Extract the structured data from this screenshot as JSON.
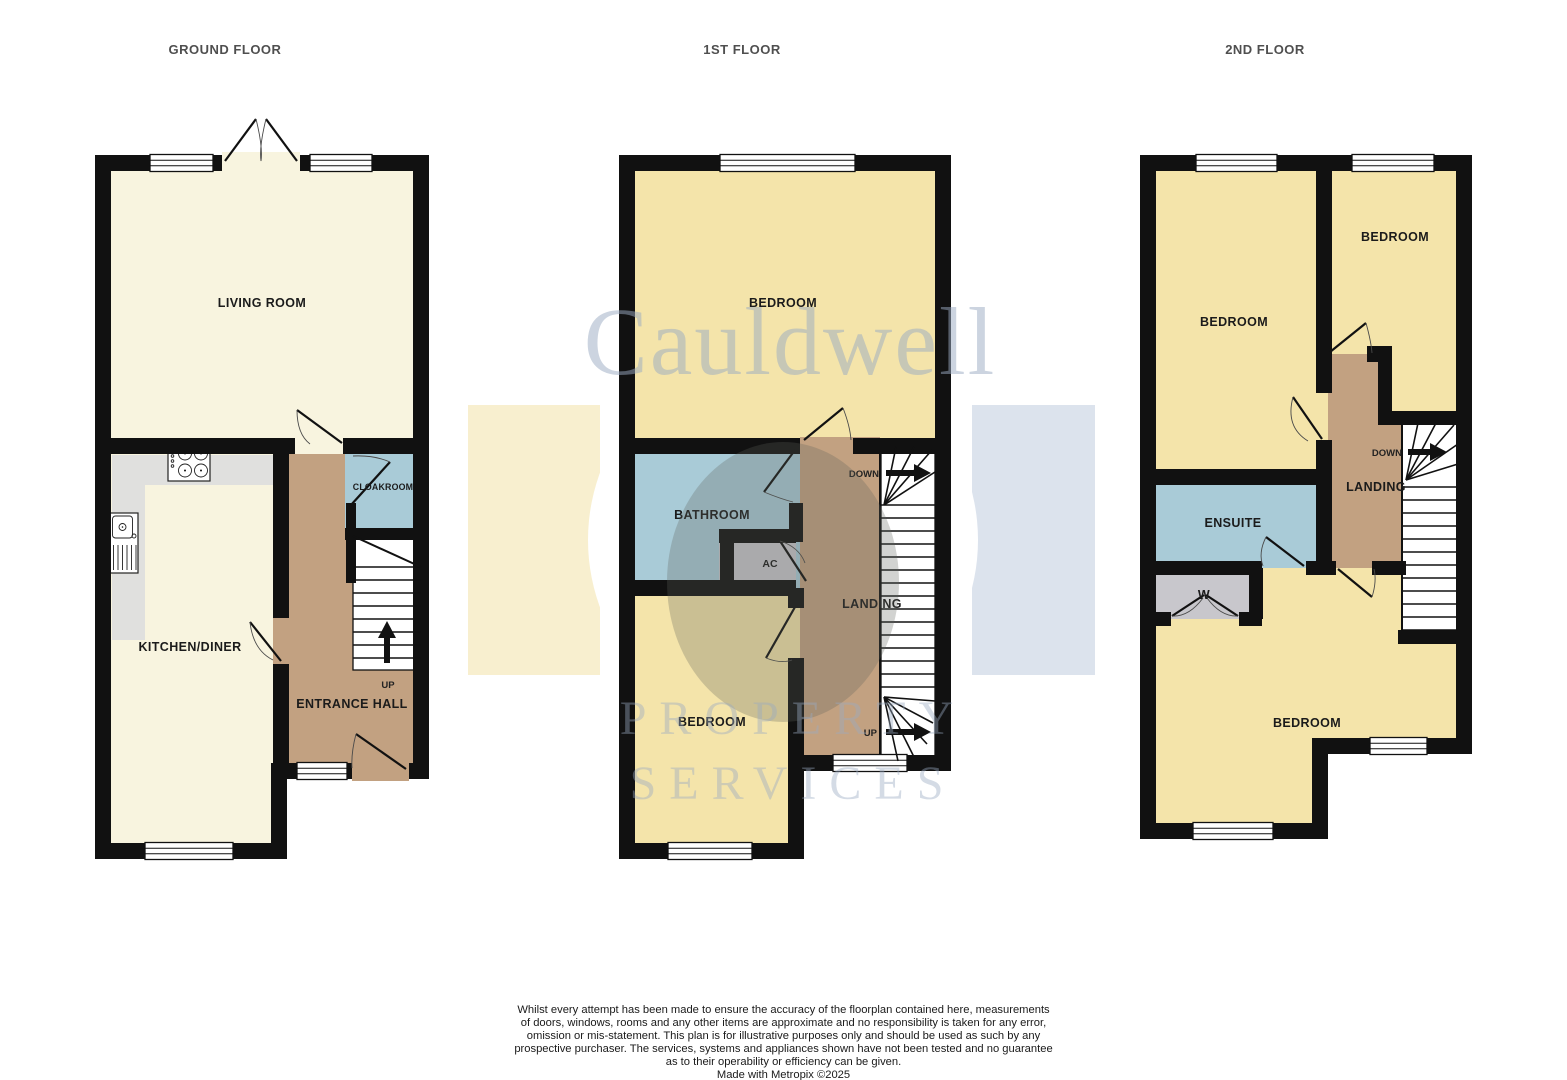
{
  "floors": [
    {
      "title": "GROUND FLOOR",
      "rooms": {
        "living_room": "LIVING ROOM",
        "kitchen_diner": "KITCHEN/DINER",
        "cloakroom": "CLOAKROOM",
        "entrance_hall": "ENTRANCE HALL"
      },
      "stairs": {
        "up_label": "UP"
      }
    },
    {
      "title": "1ST FLOOR",
      "rooms": {
        "bedroom_top": "BEDROOM",
        "bathroom": "BATHROOM",
        "airing_cupboard": "AC",
        "landing": "LANDING",
        "bedroom_bottom": "BEDROOM"
      },
      "stairs": {
        "down_label": "DOWN",
        "up_label": "UP"
      }
    },
    {
      "title": "2ND FLOOR",
      "rooms": {
        "bedroom_left": "BEDROOM",
        "bedroom_right": "BEDROOM",
        "ensuite": "ENSUITE",
        "wardrobe": "W",
        "landing": "LANDING",
        "bedroom_bottom": "BEDROOM"
      },
      "stairs": {
        "down_label": "DOWN"
      }
    }
  ],
  "watermark": {
    "brand": "Cauldwell",
    "word1": "PROPERTY",
    "word2": "SERVICES"
  },
  "disclaimer": {
    "lines": [
      "Whilst every attempt has been made to ensure the accuracy of the floorplan contained here, measurements",
      "of doors, windows, rooms and any other items are approximate and no responsibility is taken for any error,",
      "omission or mis-statement. This plan is for illustrative purposes only and should be used as such by any",
      "prospective purchaser. The services, systems and appliances shown have not been tested and no guarantee",
      "as to their operability or efficiency can be given."
    ],
    "credit": "Made with Metropix ©2025"
  },
  "palette": {
    "wall": "#111111",
    "room_cream": "#F8F4DF",
    "room_yellow": "#F4E4AA",
    "room_blue": "#A9CBD7",
    "room_tan": "#C2A181",
    "room_gray": "#C8C7CC",
    "counter": "#E0E0DE",
    "watermark_yellow": "#F8EFCF",
    "watermark_blue": "#DCE3ED",
    "watermark_text": "#9AABC2",
    "title_text": "#4F4F4F"
  }
}
